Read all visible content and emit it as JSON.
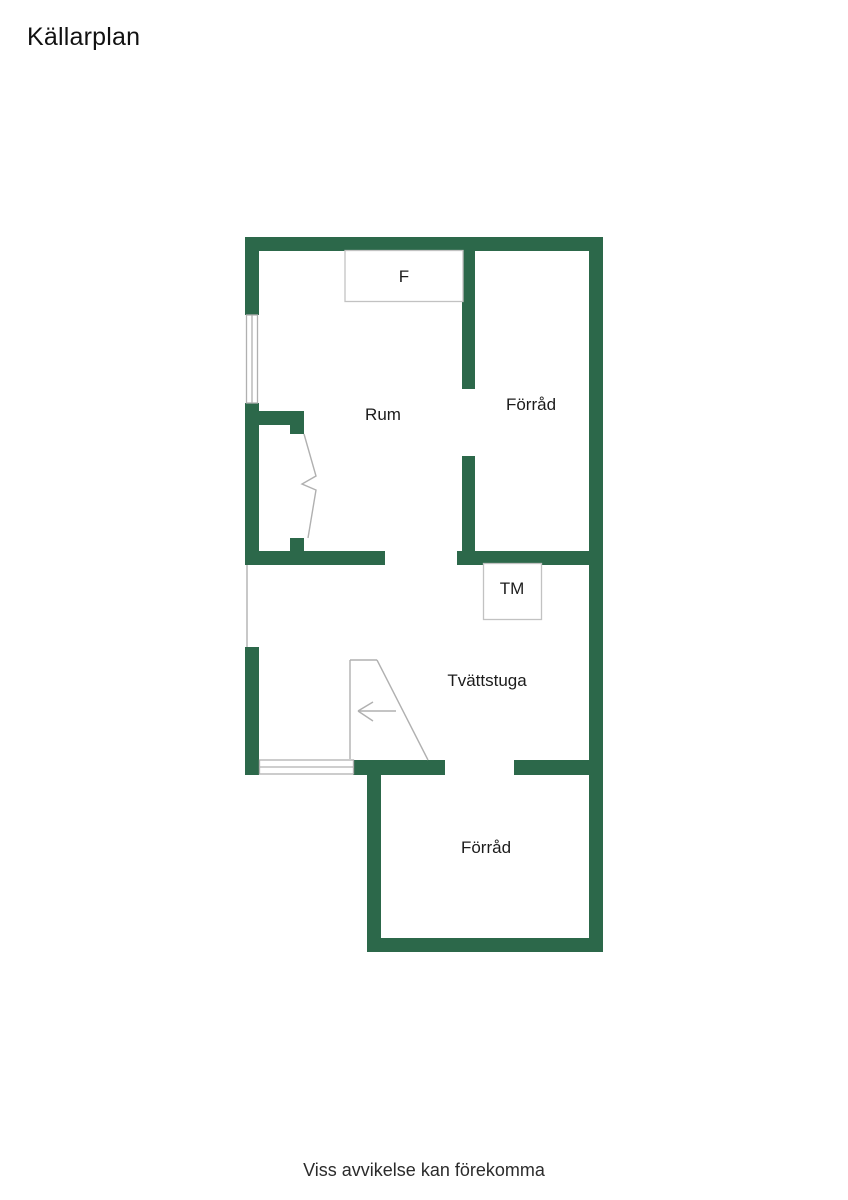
{
  "page": {
    "title": "Källarplan",
    "caption": "Viss avvikelse kan förekomma"
  },
  "colors": {
    "wall": "#2c684a",
    "symbol_line": "#b0b0b0",
    "fixture_border": "#c2c2c2",
    "label_text": "#1c1c1c",
    "background": "#ffffff"
  },
  "floorplan": {
    "rooms": [
      {
        "id": "rum",
        "label": "Rum",
        "cx": 383,
        "cy": 420
      },
      {
        "id": "forrad-top",
        "label": "Förråd",
        "cx": 531,
        "cy": 410
      },
      {
        "id": "tvattstuga",
        "label": "Tvättstuga",
        "cx": 487,
        "cy": 686
      },
      {
        "id": "forrad-bottom",
        "label": "Förråd",
        "cx": 486,
        "cy": 853
      }
    ],
    "fixtures": [
      {
        "id": "fridge-box",
        "label": "F",
        "x": 345,
        "y": 250.5,
        "w": 118,
        "h": 51,
        "lx": 404,
        "ly": 282
      },
      {
        "id": "washer-box",
        "label": "TM",
        "x": 483.5,
        "y": 563.5,
        "w": 58,
        "h": 56,
        "lx": 512,
        "ly": 594
      }
    ],
    "walls": [
      {
        "id": "wall-top",
        "x": 245,
        "y": 237,
        "w": 358,
        "h": 14
      },
      {
        "id": "wall-left-upper",
        "x": 245,
        "y": 237,
        "w": 14,
        "h": 78
      },
      {
        "id": "wall-left-mid",
        "x": 245,
        "y": 403,
        "w": 14,
        "h": 162
      },
      {
        "id": "wall-left-lower",
        "x": 245,
        "y": 647,
        "w": 14,
        "h": 128
      },
      {
        "id": "wall-right",
        "x": 589,
        "y": 237,
        "w": 14,
        "h": 715
      },
      {
        "id": "wall-divider-upper",
        "x": 462,
        "y": 251,
        "w": 13,
        "h": 138
      },
      {
        "id": "wall-divider-lower",
        "x": 462,
        "y": 456,
        "w": 13,
        "h": 95
      },
      {
        "id": "wall-band-left",
        "x": 245,
        "y": 551,
        "w": 140,
        "h": 14
      },
      {
        "id": "wall-band-right",
        "x": 457,
        "y": 551,
        "w": 132,
        "h": 14
      },
      {
        "id": "wall-door-head",
        "x": 259,
        "y": 411,
        "w": 45,
        "h": 14
      },
      {
        "id": "wall-door-jamb-top",
        "x": 290,
        "y": 425,
        "w": 14,
        "h": 9
      },
      {
        "id": "wall-door-jamb-bottom",
        "x": 290,
        "y": 538,
        "w": 14,
        "h": 13
      },
      {
        "id": "wall-tvatt-bottom-left",
        "x": 353,
        "y": 760,
        "w": 92,
        "h": 15
      },
      {
        "id": "wall-tvatt-bottom-right",
        "x": 514,
        "y": 760,
        "w": 89,
        "h": 15
      },
      {
        "id": "wall-bottomroom-left",
        "x": 367,
        "y": 760,
        "w": 14,
        "h": 192
      },
      {
        "id": "wall-bottom",
        "x": 367,
        "y": 938,
        "w": 236,
        "h": 14
      }
    ],
    "windows": [
      {
        "id": "window-left",
        "x": 246.5,
        "y": 315,
        "w": 11,
        "h": 88,
        "orient": "v"
      },
      {
        "id": "window-bottom",
        "x": 259.5,
        "y": 760,
        "w": 94,
        "h": 14,
        "orient": "h"
      }
    ],
    "symbols": [
      {
        "id": "opening-left-line",
        "points": "247,565 247,647"
      },
      {
        "id": "door-leaf",
        "points": "304,434 316,476 302,484 316,490 308,538"
      },
      {
        "id": "stair-edge-left",
        "points": "350,660 350,759"
      },
      {
        "id": "stair-edge-top",
        "points": "350,660 377,660"
      },
      {
        "id": "stair-edge-diag",
        "points": "377,660 428,760"
      },
      {
        "id": "stair-arrow-shaft",
        "points": "358,711 396,711"
      },
      {
        "id": "stair-arrow-upper",
        "points": "358,711 373,702"
      },
      {
        "id": "stair-arrow-lower",
        "points": "358,711 373,721"
      }
    ]
  }
}
